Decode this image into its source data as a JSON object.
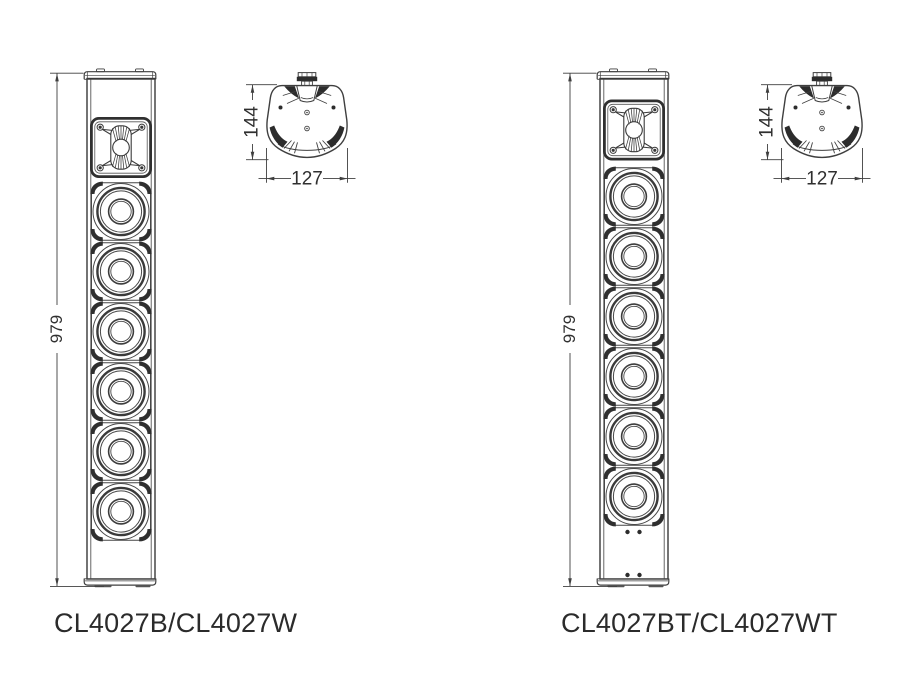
{
  "colors": {
    "background": "#ffffff",
    "line": "#3f3f3f",
    "dark_fill": "#2c2c2c",
    "text": "#2b2b2b"
  },
  "left_figure": {
    "model_label": "CL4027B/CL4027W",
    "front_view": {
      "height_dim": "979",
      "woofer_count": 6,
      "tweeter_count": 1
    },
    "top_view": {
      "depth_dim": "144",
      "width_dim": "127"
    }
  },
  "right_figure": {
    "model_label": "CL4027BT/CL4027WT",
    "front_view": {
      "height_dim": "979",
      "woofer_count": 6,
      "tweeter_count": 1,
      "mount_hole_count": 4
    },
    "top_view": {
      "depth_dim": "144",
      "width_dim": "127"
    }
  }
}
